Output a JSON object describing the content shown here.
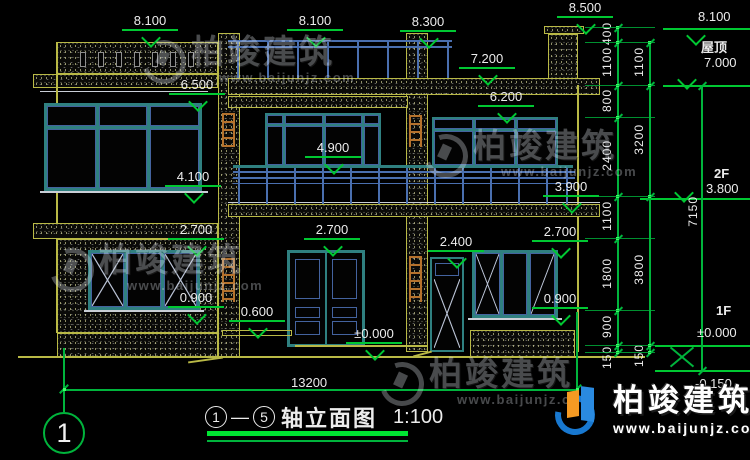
{
  "drawing": {
    "title": {
      "axis_start": "1",
      "separator": "—",
      "axis_end": "5",
      "name": "轴立面图",
      "scale": "1:100"
    },
    "axis_bubble_label": "1",
    "overall_width_dim": "13200",
    "overall_height_dim": "7150",
    "level_markers": [
      "8.100",
      "8.100",
      "8.300",
      "8.500",
      "7.200",
      "6.500",
      "6.200",
      "4.900",
      "4.100",
      "3.900",
      "2.700",
      "2.700",
      "2.400",
      "2.700",
      "0.900",
      "0.600",
      "±0.000",
      "0.900"
    ],
    "right_levels": [
      {
        "label": "8.100",
        "name": ""
      },
      {
        "label": "7.000",
        "name": "屋顶"
      },
      {
        "label": "3.800",
        "name": "2F"
      },
      {
        "label": "±0.000",
        "name": "1F"
      },
      {
        "label": "-0.150",
        "name": ""
      }
    ],
    "chain_inner": [
      "400",
      "1100",
      "800",
      "2400",
      "1100",
      "1800",
      "900",
      "150"
    ],
    "chain_outer": [
      "1100",
      "3200",
      "3800",
      "150"
    ]
  },
  "watermark": {
    "name": "柏竣建筑",
    "url": "www.baijunjz.com"
  },
  "brand": {
    "name": "柏竣建筑",
    "url": "www.baijunjz.com"
  },
  "colors": {
    "outline_yellow": "#b9b946",
    "frame_teal": "#2f8080",
    "glass_blue": "#4a6faf",
    "dim_green": "#00c832",
    "text_white": "#ececec",
    "decor_orange": "#b5722d",
    "brand_blue": "#1878d0",
    "brand_orange": "#f59a23"
  }
}
